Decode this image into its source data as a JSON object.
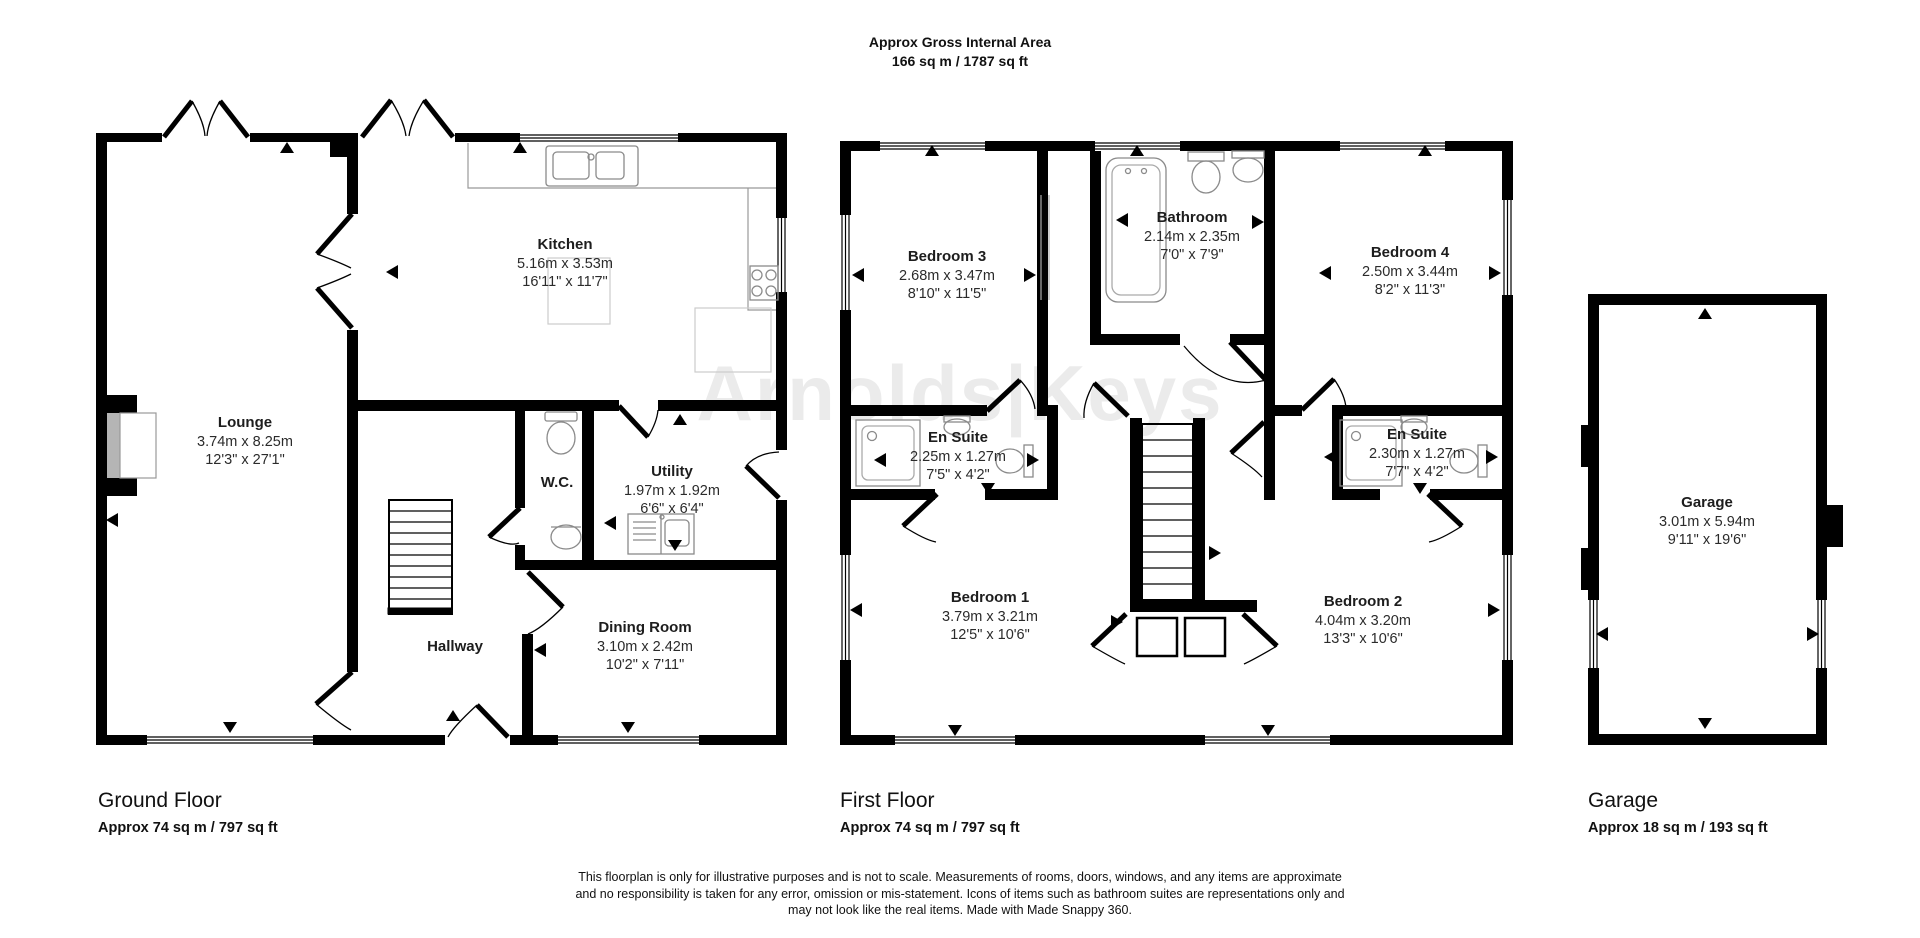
{
  "header": {
    "title": "Approx Gross Internal Area",
    "area": "166 sq m / 1787 sq ft"
  },
  "watermark": "Arnolds|Keys",
  "floors": {
    "ground": {
      "label": "Ground Floor",
      "area": "Approx 74 sq m / 797 sq ft"
    },
    "first": {
      "label": "First Floor",
      "area": "Approx 74 sq m / 797 sq ft"
    },
    "garage": {
      "label": "Garage",
      "area": "Approx 18 sq m / 193 sq ft"
    }
  },
  "rooms": {
    "kitchen": {
      "name": "Kitchen",
      "metric": "5.16m x 3.53m",
      "imperial": "16'11\" x 11'7\""
    },
    "lounge": {
      "name": "Lounge",
      "metric": "3.74m x 8.25m",
      "imperial": "12'3\" x 27'1\""
    },
    "wc": {
      "name": "W.C."
    },
    "utility": {
      "name": "Utility",
      "metric": "1.97m x 1.92m",
      "imperial": "6'6\" x 6'4\""
    },
    "hallway": {
      "name": "Hallway"
    },
    "dining": {
      "name": "Dining Room",
      "metric": "3.10m x 2.42m",
      "imperial": "10'2\" x 7'11\""
    },
    "bedroom3": {
      "name": "Bedroom 3",
      "metric": "2.68m x 3.47m",
      "imperial": "8'10\" x 11'5\""
    },
    "bathroom": {
      "name": "Bathroom",
      "metric": "2.14m x 2.35m",
      "imperial": "7'0\" x 7'9\""
    },
    "bedroom4": {
      "name": "Bedroom 4",
      "metric": "2.50m x 3.44m",
      "imperial": "8'2\" x 11'3\""
    },
    "ensuite1": {
      "name": "En Suite",
      "metric": "2.25m x 1.27m",
      "imperial": "7'5\" x 4'2\""
    },
    "ensuite2": {
      "name": "En Suite",
      "metric": "2.30m x 1.27m",
      "imperial": "7'7\" x 4'2\""
    },
    "bedroom1": {
      "name": "Bedroom 1",
      "metric": "3.79m x 3.21m",
      "imperial": "12'5\" x 10'6\""
    },
    "bedroom2": {
      "name": "Bedroom 2",
      "metric": "4.04m x 3.20m",
      "imperial": "13'3\" x 10'6\""
    },
    "garage": {
      "name": "Garage",
      "metric": "3.01m x 5.94m",
      "imperial": "9'11\" x 19'6\""
    }
  },
  "disclaimer": [
    "This floorplan is only for illustrative purposes and is not to scale. Measurements of rooms, doors, windows, and any items are approximate",
    "and no responsibility is taken for any error, omission or mis-statement. Icons of items such as bathroom suites are representations only and",
    "may not look like the real items. Made with Made Snappy 360."
  ]
}
